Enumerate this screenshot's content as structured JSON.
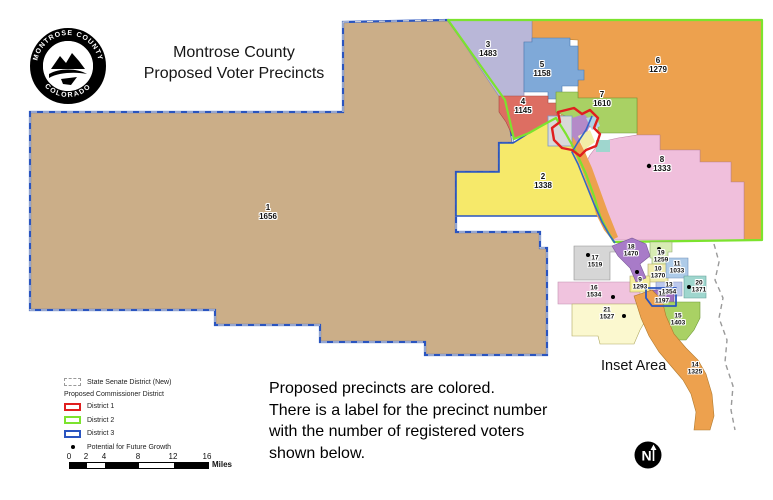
{
  "header": {
    "title_line1": "Montrose County",
    "title_line2": "Proposed Voter Precincts"
  },
  "logo": {
    "top_text": "MONTROSE COUNTY",
    "bottom_text": "COLORADO"
  },
  "note_lines": [
    "Proposed precincts are colored.",
    "There is a label for the precinct number",
    "with the number of registered voters",
    "shown below."
  ],
  "inset_area_label": "Inset Area",
  "north_arrow_label": "N",
  "legend": {
    "senate_label": "State Senate District (New)",
    "commissioner_header": "Proposed Commissioner District",
    "district1_label": "District 1",
    "district2_label": "District 2",
    "district3_label": "District 3",
    "growth_label": "Potential for Future Growth",
    "scale_ticks": [
      "0",
      "2",
      "4",
      "8",
      "12",
      "16"
    ],
    "scale_unit": "Miles"
  },
  "colors": {
    "district1": "#e01f1f",
    "district2": "#7ce32e",
    "district3": "#2a55c0",
    "senate_dash": "#9a9a9a",
    "river": "#3465c8"
  },
  "precincts": [
    {
      "number": "1",
      "voters": "1656",
      "color": "#cbae88"
    },
    {
      "number": "2",
      "voters": "1338",
      "color": "#f6e96a"
    },
    {
      "number": "3",
      "voters": "1483",
      "color": "#b9b7d8"
    },
    {
      "number": "4",
      "voters": "1145",
      "color": "#dd6e62"
    },
    {
      "number": "5",
      "voters": "1158",
      "color": "#7fa9d8"
    },
    {
      "number": "6",
      "voters": "1279",
      "color": "#eda14e"
    },
    {
      "number": "7",
      "voters": "1610",
      "color": "#a9d164"
    },
    {
      "number": "8",
      "voters": "1333",
      "color": "#f0bfdc"
    },
    {
      "number": "9",
      "voters": "1293",
      "color": "#f5ef9a"
    },
    {
      "number": "10",
      "voters": "1370",
      "color": "#f0ecac"
    },
    {
      "number": "11",
      "voters": "1033",
      "color": "#aecbe8"
    },
    {
      "number": "12",
      "voters": "1197",
      "color": "#9e6fc0"
    },
    {
      "number": "13",
      "voters": "1354",
      "color": "#bcc8ec"
    },
    {
      "number": "14",
      "voters": "1325",
      "color": "#eda14e"
    },
    {
      "number": "15",
      "voters": "1403",
      "color": "#a9d164"
    },
    {
      "number": "16",
      "voters": "1534",
      "color": "#f0c3de"
    },
    {
      "number": "17",
      "voters": "1519",
      "color": "#d6d6d6"
    },
    {
      "number": "18",
      "voters": "1470",
      "color": "#a87bc8"
    },
    {
      "number": "19",
      "voters": "1259",
      "color": "#d8ecb4"
    },
    {
      "number": "20",
      "voters": "1371",
      "color": "#9fd6ce"
    },
    {
      "number": "21",
      "voters": "1527",
      "color": "#fbf8cf"
    }
  ]
}
